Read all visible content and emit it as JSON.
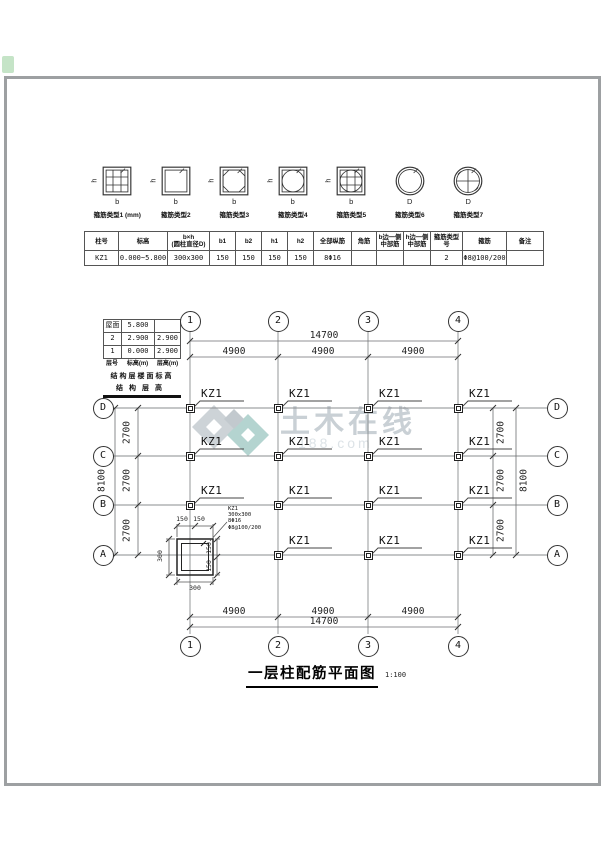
{
  "stirrup_legend": {
    "items": [
      {
        "type": "square-grid",
        "side": "h",
        "base": "b",
        "caption": "箍筋类型1 (mm)"
      },
      {
        "type": "square",
        "side": "h",
        "base": "b",
        "caption": "箍筋类型2"
      },
      {
        "type": "square-octagon",
        "side": "h",
        "base": "b",
        "caption": "箍筋类型3"
      },
      {
        "type": "square-circle",
        "side": "h",
        "base": "b",
        "caption": "箍筋类型4"
      },
      {
        "type": "square-circle-grid",
        "side": "h",
        "base": "b",
        "caption": "箍筋类型5"
      },
      {
        "type": "circle",
        "side": "",
        "base": "D",
        "caption": "箍筋类型6"
      },
      {
        "type": "circle-grid",
        "side": "",
        "base": "D",
        "caption": "箍筋类型7"
      }
    ]
  },
  "column_schedule": {
    "headers": [
      "柱号",
      "标高",
      "b×h\n(圆柱直径D)",
      "b1",
      "b2",
      "h1",
      "h2",
      "全部纵筋",
      "角筋",
      "b边一侧\n中部筋",
      "h边一侧\n中部筋",
      "箍筋类型号",
      "箍筋",
      "备注"
    ],
    "rows": [
      [
        "KZ1",
        "0.000~5.800",
        "300x300",
        "150",
        "150",
        "150",
        "150",
        "8Φ16",
        "",
        "",
        "",
        "2",
        "Φ8@100/200",
        ""
      ]
    ]
  },
  "level_table": {
    "rows": [
      {
        "level": "屋面",
        "elev": "5.800",
        "height": ""
      },
      {
        "level": "2",
        "elev": "2.900",
        "height": "2.900"
      },
      {
        "level": "1",
        "elev": "0.000",
        "height": "2.900"
      }
    ],
    "col_headers": [
      "层号",
      "标高(m)",
      "层高(m)"
    ],
    "note1": "结构层楼面标高",
    "note2": "结构层高"
  },
  "plan": {
    "column_axes": [
      "1",
      "2",
      "3",
      "4"
    ],
    "row_axes": [
      "D",
      "C",
      "B",
      "A"
    ],
    "dims": {
      "top_total": "14700",
      "top_spans": [
        "4900",
        "4900",
        "4900"
      ],
      "bottom_total": "14700",
      "bottom_spans": [
        "4900",
        "4900",
        "4900"
      ],
      "left_total": "8100",
      "left_spans": [
        "2700",
        "2700",
        "2700"
      ],
      "right_total": "8100",
      "right_spans": [
        "2700",
        "2700",
        "2700"
      ]
    },
    "column_mark": "KZ1",
    "detail": {
      "callout": [
        "KZ1",
        "300x300",
        "8Φ16",
        "Φ8@100/200"
      ],
      "top_dims": [
        "150",
        "150"
      ],
      "right_dims": [
        "150",
        "150"
      ],
      "left_dim": "300",
      "bottom_dim": "300"
    }
  },
  "watermark": {
    "text": "土木在线",
    "subtext": "188.com",
    "text_color": "#c9d0d5",
    "accent_color": "#b4d4d0",
    "gray_color": "#cdd3d7"
  },
  "title_block": {
    "title": "一层柱配筋平面图",
    "scale": "1:100"
  }
}
